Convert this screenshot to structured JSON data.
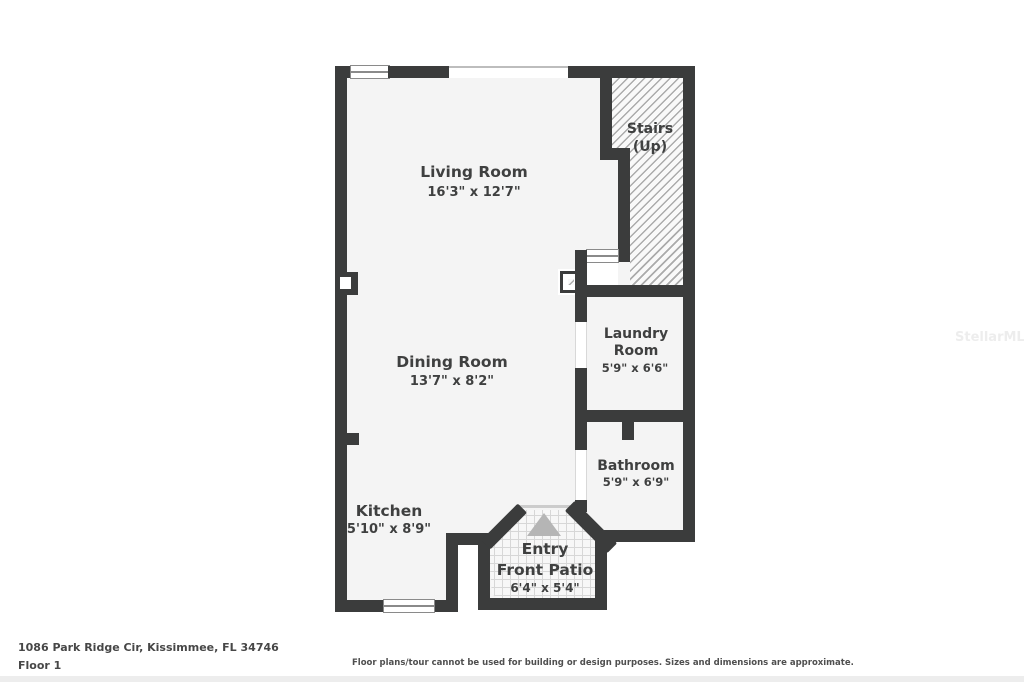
{
  "rooms": {
    "living": {
      "name": "Living Room",
      "dims": "16'3\" x 12'7\""
    },
    "dining": {
      "name": "Dining Room",
      "dims": "13'7\" x 8'2\""
    },
    "kitchen": {
      "name": "Kitchen",
      "dims": "5'10\" x 8'9\""
    },
    "laundry": {
      "name": "Laundry Room",
      "dims": "5'9\" x 6'6\""
    },
    "bathroom": {
      "name": "Bathroom",
      "dims": "5'9\" x 6'9\""
    },
    "stairs": {
      "name": "Stairs",
      "sub": "(Up)"
    },
    "entry": {
      "name": "Entry",
      "name2": "Front Patio",
      "dims": "6'4\" x 5'4\""
    }
  },
  "footer": {
    "address": "1086 Park Ridge Cir, Kissimmee, FL 34746",
    "floor": "Floor 1",
    "disclaimer": "Floor plans/tour cannot be used for building or design purposes. Sizes and dimensions are approximate."
  },
  "watermark": "StellarMLS",
  "colors": {
    "wall": "#3b3c3c",
    "floor": "#f4f4f4",
    "text": "#3f4040",
    "arrow": "#b5b5b5"
  }
}
